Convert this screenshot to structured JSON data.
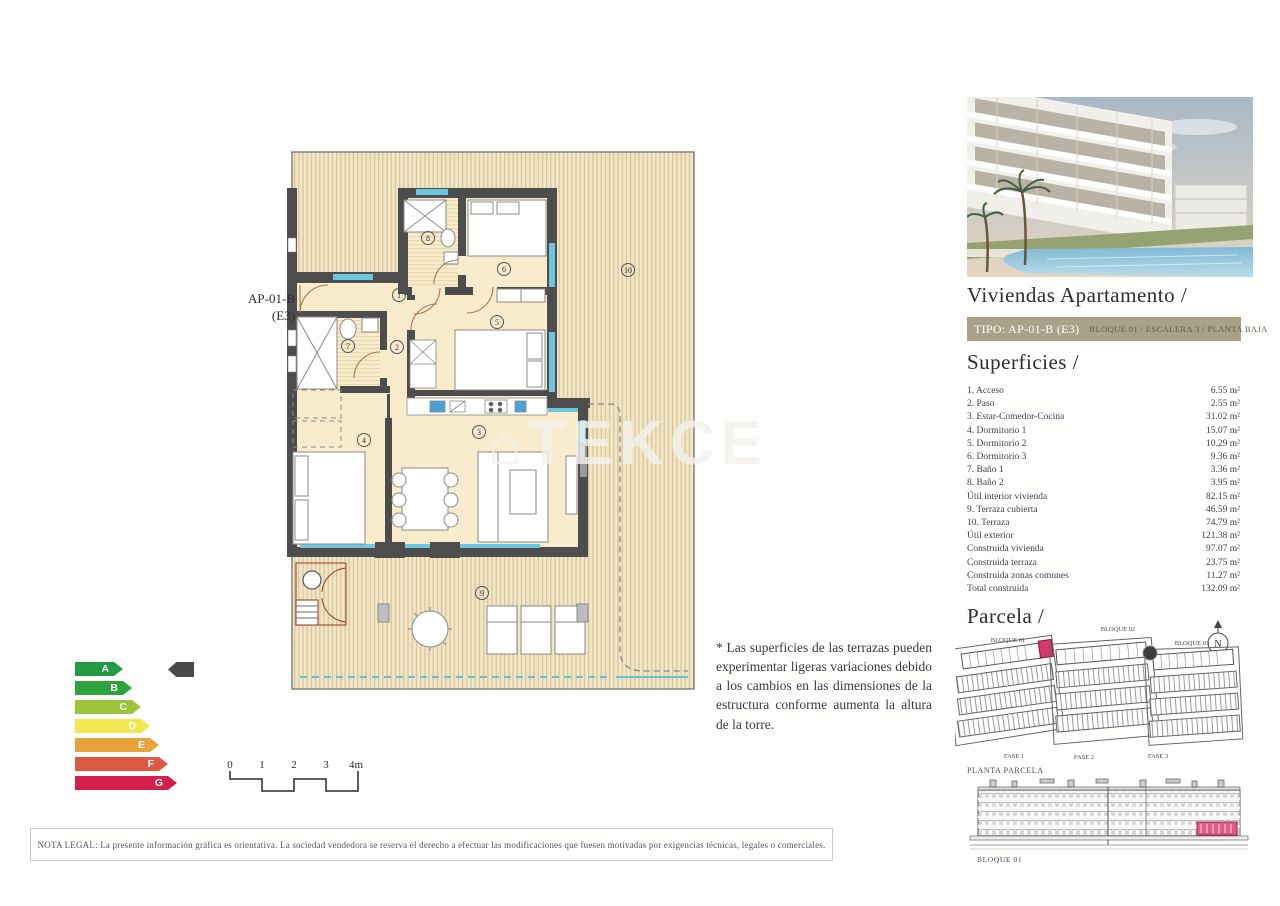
{
  "plan": {
    "unit_label_line1": "AP-01-B",
    "unit_label_line2": "(E3)",
    "rooms": [
      "1",
      "2",
      "3",
      "4",
      "5",
      "6",
      "7",
      "8",
      "9",
      "10"
    ],
    "scale": [
      "0",
      "1",
      "2",
      "3",
      "4m"
    ]
  },
  "watermark": {
    "icon": "⌂",
    "text": "TEKCE"
  },
  "note": "* Las superficies de las terrazas pueden experimentar ligeras variaciones debido a los cambios en las dimensiones de la estructura conforme aumenta la altura de la torre.",
  "energy": {
    "grades": [
      {
        "letter": "A",
        "color": "#239b45",
        "width": 48
      },
      {
        "letter": "B",
        "color": "#2ea33c",
        "width": 57
      },
      {
        "letter": "C",
        "color": "#9dc23b",
        "width": 66
      },
      {
        "letter": "D",
        "color": "#f0e751",
        "width": 75
      },
      {
        "letter": "E",
        "color": "#e9a23b",
        "width": 84
      },
      {
        "letter": "F",
        "color": "#dc5944",
        "width": 93
      },
      {
        "letter": "G",
        "color": "#d21f4c",
        "width": 102
      }
    ]
  },
  "sidebar": {
    "title": "Viviendas Apartamento /",
    "tipo": {
      "left": "TIPO: AP-01-B (E3)",
      "right": "BLOQUE 01  / ESCALERA 3 / PLANTA BAJA"
    },
    "superficies": {
      "heading": "Superficies /",
      "rows": [
        {
          "label": "1. Acceso",
          "value": "6.55 m²"
        },
        {
          "label": "2. Paso",
          "value": "2.55 m²"
        },
        {
          "label": "3. Estar-Comedor-Cocina",
          "value": "31.02 m²"
        },
        {
          "label": "4. Dormitorio 1",
          "value": "15.07 m²"
        },
        {
          "label": "5. Dormitorio 2",
          "value": "10.29 m²"
        },
        {
          "label": "6. Dormitorio 3",
          "value": "9.36 m²"
        },
        {
          "label": "7. Baño 1",
          "value": "3.36 m²"
        },
        {
          "label": "8. Baño 2",
          "value": "3.95 m²"
        },
        {
          "label": "Útil interior vivienda",
          "value": "82.15 m²"
        },
        {
          "label": "9. Terraza cubierta",
          "value": "46.59 m²"
        },
        {
          "label": "10. Terraza",
          "value": "74.79 m²"
        },
        {
          "label": "Útil exterior",
          "value": "121.38 m²"
        },
        {
          "label": "Construida vivienda",
          "value": "97.07 m²"
        },
        {
          "label": "Construida terraza",
          "value": "23.75 m²"
        },
        {
          "label": "Construida zonas comunes",
          "value": "11.27 m²"
        },
        {
          "label": "Total construida",
          "value": "132.09 m²"
        }
      ]
    },
    "parcela": {
      "heading": "Parcela /",
      "bloques": [
        "BLOQUE 01",
        "BLOQUE 02",
        "BLOQUE 03"
      ],
      "fases": [
        "FASE 1",
        "FASE 2",
        "FASE 3"
      ],
      "compass": "N",
      "caption": "PLANTA PARCELA",
      "elevation_label": "BLOQUE 01"
    }
  },
  "legal": "NOTA LEGAL: La presente información gráfica es orientativa. La sociedad vendedora se reserva el derecho a efectuar las modificaciones que fuesen motivadas por exigencias técnicas, legales o comerciales.",
  "colors": {
    "wall": "#4d4d4d",
    "room_fill": "#f8eccd",
    "deck_stripe": "#d9c69c",
    "glazing": "#5fc4dc",
    "highlight_unit": "#d6356e",
    "tipo_bar": "#a9a189"
  }
}
